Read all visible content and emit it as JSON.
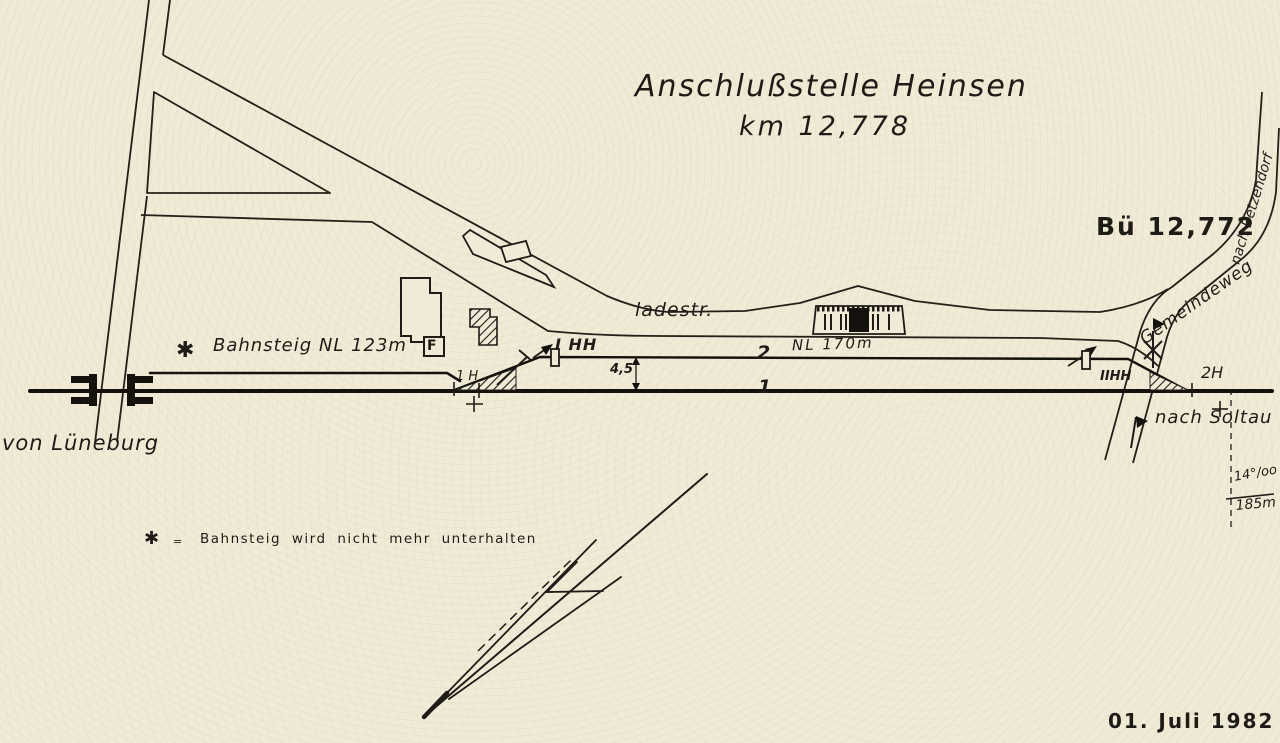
{
  "colors": {
    "paper": "#f0ead6",
    "ink": "#1f1c17"
  },
  "title": {
    "line1": "Anschlußstelle Heinsen",
    "line2": "km 12,778"
  },
  "station": {
    "crossing_label": "Bü 12,772",
    "road_to_betzendorf": "nach Betzendorf",
    "road_name": "Gemeindeweg",
    "loading_street": "ladestr.",
    "platform_note": "Bahnsteig NL 123m",
    "platform_star": "✱",
    "phone_box": "F",
    "track2_number": "2",
    "track2_length": "NL 170m",
    "track1_number": "1",
    "track_spacing": "4,5",
    "switch1_label": "1 H",
    "signal_left": "I HH",
    "signal_right": "IIHH",
    "switch2_label": "2H",
    "to_soltau": "nach Soltau",
    "from_lueneburg": "von Lüneburg",
    "gradient_value": "14°/oo",
    "gradient_length": "185m"
  },
  "legend": {
    "symbol": "✱",
    "separator": "=",
    "text": "Bahnsteig wird nicht mehr unterhalten"
  },
  "date": "01. Juli 1982"
}
